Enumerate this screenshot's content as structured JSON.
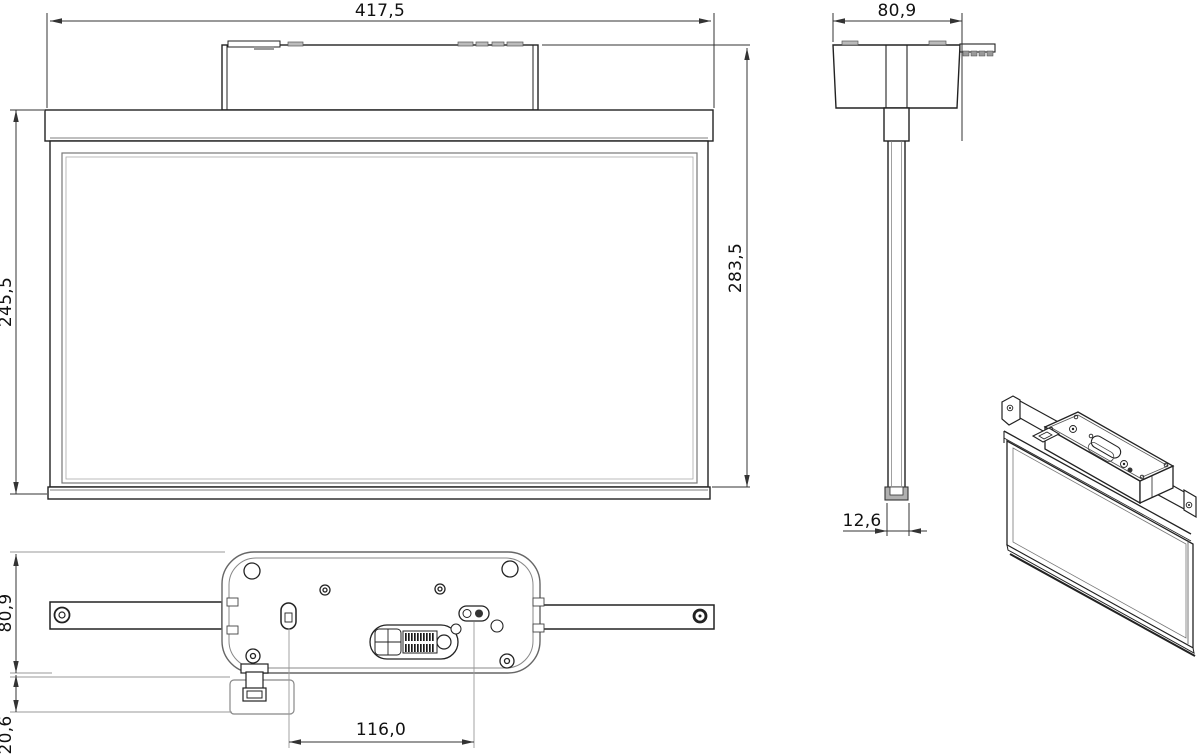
{
  "drawing": {
    "background": "#ffffff",
    "line_color": "#222222",
    "dim_color": "#333333",
    "aux_color": "#999999",
    "dimensions": {
      "front_width": "417,5",
      "front_panel_height": "245,5",
      "front_total_height": "283,5",
      "side_width": "80,9",
      "side_profile_width": "12,6",
      "bottom_body_width": "80,9",
      "bottom_clip_depth": "20,6",
      "bottom_hole_spacing": "116,0"
    }
  }
}
